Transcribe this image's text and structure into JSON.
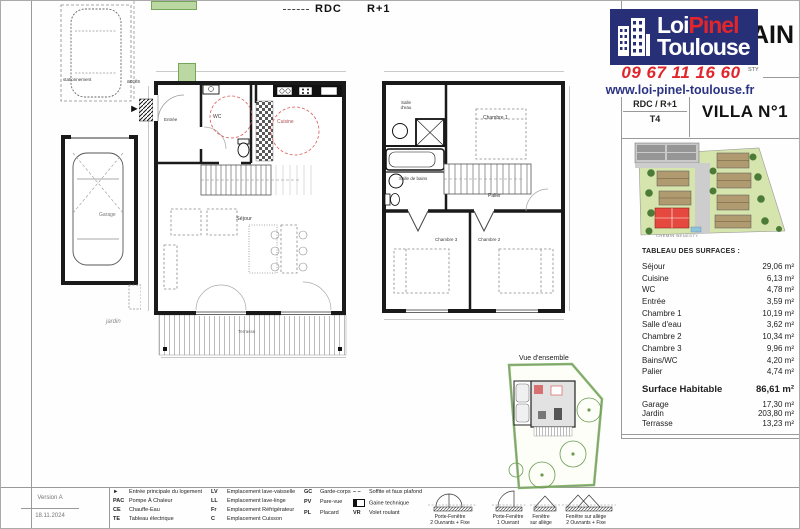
{
  "header": {
    "logo_line1a": "Loi",
    "logo_line1b": "Pinel",
    "logo_line2": "Toulouse",
    "phone": "09 67 11 16 60",
    "website": "www.loi-pinel-toulouse.fr",
    "partial_title": "AIN",
    "partial_subtitle": "STY",
    "level_label": "RDC / R+1",
    "type_label": "T4",
    "villa_label": "VILLA N°1"
  },
  "plans": {
    "rdc_label": "RDC",
    "r1_label": "R+1",
    "overview_label": "Vue d'ensemble",
    "street_label": "CHEMIN BENESTY",
    "rooms": {
      "entree": "Entrée",
      "wc": "WC",
      "cuisine": "Cuisine",
      "sejour": "Séjour",
      "terrasse": "Terrasse",
      "salle_deau": "Salle d'eau",
      "chambre1": "Chambre 1",
      "salle_de_bains": "Salle de bains",
      "palier": "Palier",
      "chambre3": "Chambre 3",
      "chambre2": "Chambre 2",
      "garage": "Garage",
      "jardin": "jardin",
      "stationnement": "stationnement",
      "acces": "accès"
    }
  },
  "surfaces": {
    "title": "TABLEAU DES SURFACES :",
    "rows": [
      {
        "label": "Séjour",
        "value": "29,06 m²"
      },
      {
        "label": "Cuisine",
        "value": "6,13 m²"
      },
      {
        "label": "WC",
        "value": "4,78 m²"
      },
      {
        "label": "Entrée",
        "value": "3,59 m²"
      },
      {
        "label": "Chambre 1",
        "value": "10,19 m²"
      },
      {
        "label": "Salle d'eau",
        "value": "3,62 m²"
      },
      {
        "label": "Chambre 2",
        "value": "10,34 m²"
      },
      {
        "label": "Chambre 3",
        "value": "9,96 m²"
      },
      {
        "label": "Bains/WC",
        "value": "4,20 m²"
      },
      {
        "label": "Palier",
        "value": "4,74 m²"
      }
    ],
    "total": {
      "label": "Surface Habitable",
      "value": "86,61 m²"
    },
    "extras": [
      {
        "label": "Garage",
        "value": "17,30 m²"
      },
      {
        "label": "Jardin",
        "value": "203,80 m²"
      },
      {
        "label": "Terrasse",
        "value": "13,23 m²"
      }
    ]
  },
  "legend": {
    "col1": [
      {
        "sym": "►",
        "text": "Entrée principale du logement"
      },
      {
        "sym": "PAC",
        "text": "Pompe À Chaleur"
      },
      {
        "sym": "CE",
        "text": "Chauffe-Eau"
      },
      {
        "sym": "TE",
        "text": "Tableau électrique"
      }
    ],
    "col2": [
      {
        "sym": "LV",
        "text": "Emplacement lave-vaisselle"
      },
      {
        "sym": "LL",
        "text": "Emplacement lave-linge"
      },
      {
        "sym": "Fr",
        "text": "Emplacement Réfrigérateur"
      },
      {
        "sym": "C",
        "text": "Emplacement Cuisson"
      }
    ],
    "col3": [
      {
        "sym": "GC",
        "text": "Garde-corps"
      },
      {
        "sym": "PV",
        "text": "Pare-vue"
      },
      {
        "sym": "PL",
        "text": "Placard"
      }
    ],
    "col4": [
      {
        "sym": "– –",
        "text": "Soffite et faux plafond"
      },
      {
        "sym": "",
        "text": "Gaine technique"
      },
      {
        "sym": "VR",
        "text": "Volet roulant"
      }
    ],
    "windows": [
      {
        "l1": "Porte-Fenêtre",
        "l2": "2 Ouvrants + Fixe"
      },
      {
        "l1": "Porte-Fenêtre",
        "l2": "1 Ouvrant"
      },
      {
        "l1": "Fenêtre",
        "l2": "sur allège"
      },
      {
        "l1": "Fenêtre sur allège",
        "l2": "2 Ouvrants + Fixe"
      }
    ]
  },
  "meta": {
    "version": "Version A",
    "date": "18.11.2024"
  },
  "colors": {
    "navy": "#272f77",
    "red": "#e0262c",
    "plan_red": "#d95b5b",
    "lawn_green": "#d6e5ad",
    "hedge_green": "#86b86a",
    "house_red": "#e5483e"
  }
}
